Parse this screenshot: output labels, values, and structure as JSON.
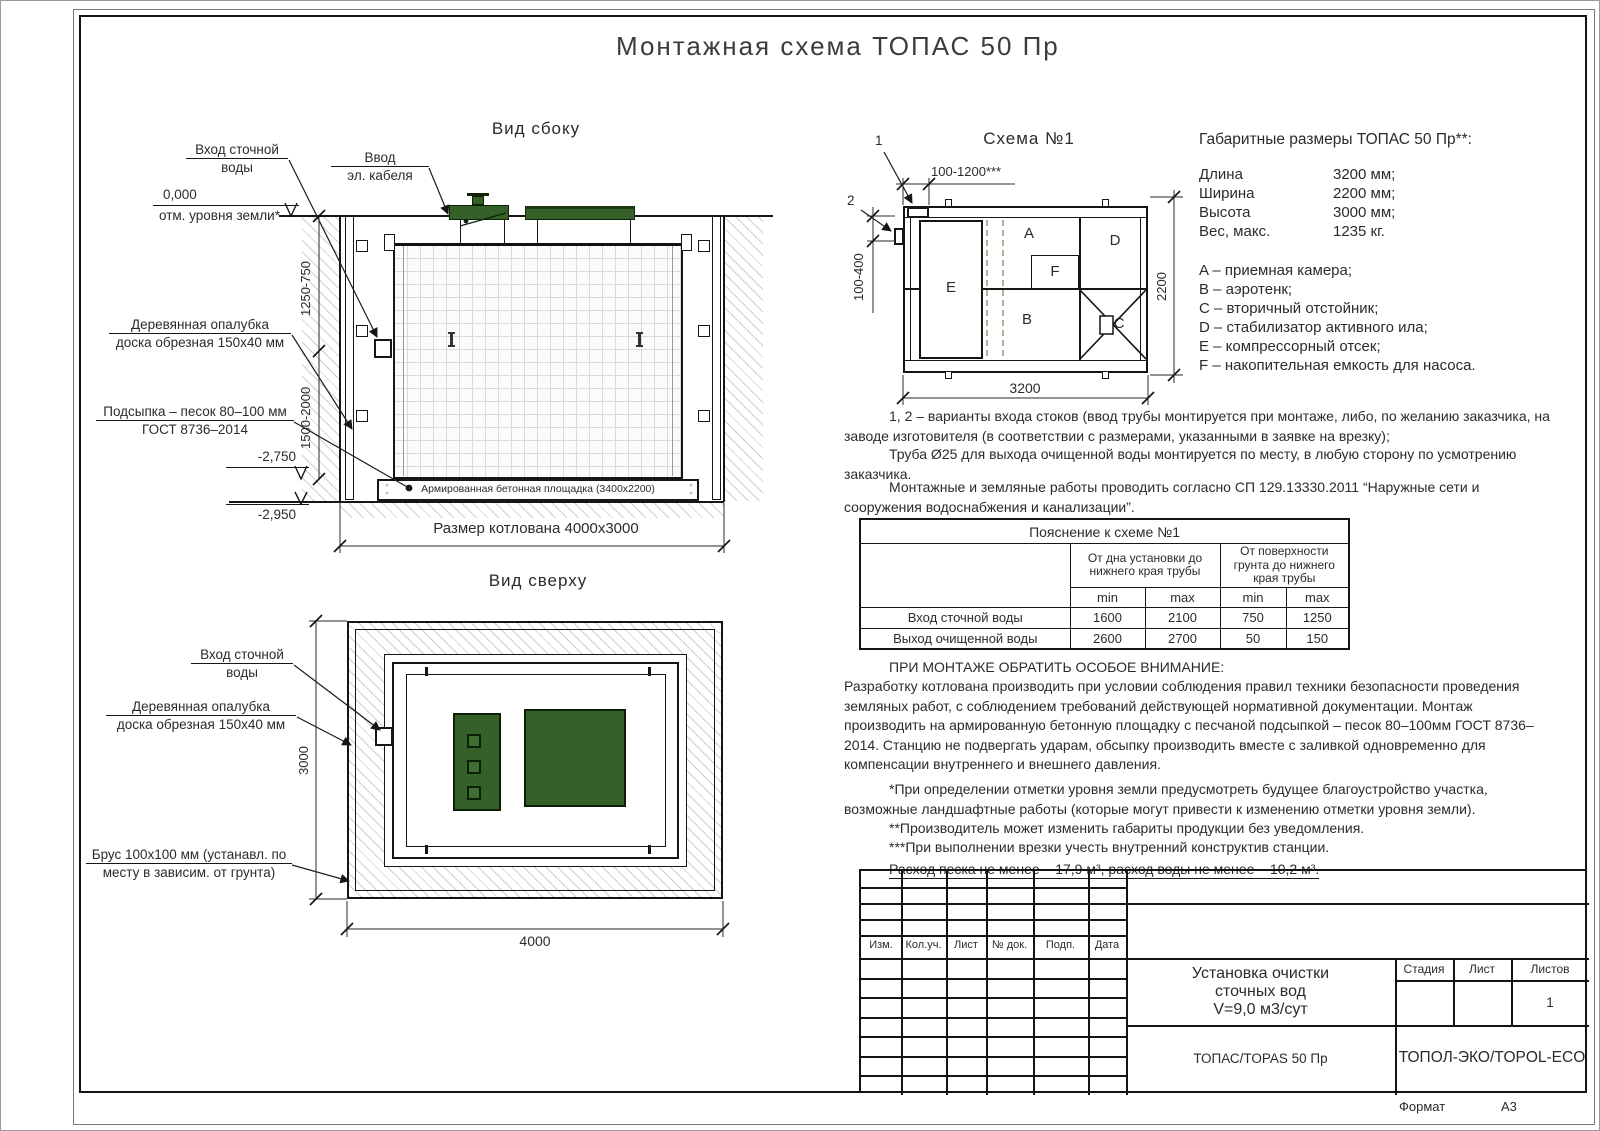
{
  "page": {
    "title": "Монтажная схема ТОПАС 50 Пр",
    "format_label": "Формат",
    "format_value": "А3"
  },
  "side_view": {
    "title": "Вид сбоку",
    "inlet_label_1": "Вход сточной",
    "inlet_label_2": "воды",
    "cable_label_1": "Ввод",
    "cable_label_2": "эл. кабеля",
    "level_zero": "0,000",
    "level_zero_sub": "отм. уровня земли*",
    "dim_upper": "1250-750",
    "dim_lower": "1500-2000",
    "formwork_label_1": "Деревянная опалубка",
    "formwork_label_2": "доска обрезная 150x40 мм",
    "bedding_label_1": "Подсыпка – песок 80–100 мм",
    "bedding_label_2": "ГОСТ 8736–2014",
    "level_slab": "-2,750",
    "level_bottom": "-2,950",
    "slab_label": "Армированная бетонная площадка (3400x2200)",
    "pit_label": "Размер котлована 4000x3000"
  },
  "top_view": {
    "title": "Вид сверху",
    "inlet_label_1": "Вход сточной",
    "inlet_label_2": "воды",
    "formwork_label_1": "Деревянная опалубка",
    "formwork_label_2": "доска обрезная 150x40 мм",
    "beam_label_1": "Брус 100x100 мм (устанавл. по",
    "beam_label_2": "месту в зависим. от грунта)",
    "dim_height": "3000",
    "dim_width": "4000"
  },
  "schema": {
    "title": "Схема №1",
    "callout_1": "1",
    "callout_2": "2",
    "dim_top": "100-1200***",
    "dim_left": "100-400",
    "dim_right": "2200",
    "dim_bottom": "3200",
    "compartments": {
      "a": "A",
      "b": "B",
      "c": "C",
      "d": "D",
      "e": "E",
      "f": "F"
    }
  },
  "specs": {
    "title": "Габаритные размеры ТОПАС 50 Пр**:",
    "rows": [
      {
        "label": "Длина",
        "value": "3200 мм;"
      },
      {
        "label": "Ширина",
        "value": "2200 мм;"
      },
      {
        "label": "Высота",
        "value": "3000 мм;"
      },
      {
        "label": "Вес, макс.",
        "value": "1235 кг."
      }
    ],
    "legend": [
      "A – приемная камера;",
      "B – аэротенк;",
      "C – вторичный отстойник;",
      "D – стабилизатор активного ила;",
      "E – компрессорный отсек;",
      "F – накопительная емкость для насоса."
    ]
  },
  "notes": {
    "p1": "1, 2 – варианты входа  стоков (ввод трубы монтируется при монтаже, либо, по желанию заказчика, на заводе изготовителя (в соответствии с размерами, указанными в заявке на врезку);",
    "p2": "Труба Ø25 для выхода очищенной воды монтируется по месту, в любую сторону по усмотрению заказчика.",
    "p3": "Монтажные и земляные работы проводить согласно СП 129.13330.2011 “Наружные сети и сооружения водоснабжения и канализации”."
  },
  "explain_table": {
    "title": "Пояснение к схеме №1",
    "group1": "От дна установки до нижнего края трубы",
    "group2": "От поверхности грунта до нижнего края трубы",
    "min_label": "min",
    "max_label": "max",
    "rows": [
      {
        "label": "Вход сточной воды",
        "v1": "1600",
        "v2": "2100",
        "v3": "750",
        "v4": "1250"
      },
      {
        "label": "Выход очищенной воды",
        "v1": "2600",
        "v2": "2700",
        "v3": "50",
        "v4": "150"
      }
    ]
  },
  "attention": {
    "heading": "ПРИ МОНТАЖЕ ОБРАТИТЬ ОСОБОЕ ВНИМАНИЕ:",
    "body": "Разработку котлована производить при условии соблюдения правил техники безопасности проведения земляных работ, с соблюдением требований действующей нормативной документации.  Монтаж производить на армированную бетонную площадку с песчаной подсыпкой – песок 80–100мм ГОСТ 8736–2014. Станцию не подвергать ударам, обсыпку производить вместе с заливкой одновременно для компенсации внутреннего и внешнего давления.",
    "fn1": "*При определении отметки уровня земли предусмотреть будущее благоустройство участка, возможные ландшафтные работы (которые могут привести к изменению отметки уровня земли).",
    "fn2": "**Производитель может изменить габариты продукции без уведомления.",
    "fn3": "***При выполнении врезки учесть внутренний конструктив станции.",
    "consumption": "Расход песка не менее – 17,9 м³, расход воды не менее – 10,2 м³."
  },
  "title_block": {
    "cols": [
      "Изм.",
      "Кол.уч.",
      "Лист",
      "№ док.",
      "Подп.",
      "Дата"
    ],
    "doc_title_1": "Установка очистки",
    "doc_title_2": "сточных вод",
    "doc_title_3": "V=9,0 м3/сут",
    "product": "ТОПАС/TOPAS 50 Пр",
    "company": "ТОПОЛ-ЭКО/TOPOL-ECO",
    "stage": "Стадия",
    "sheet": "Лист",
    "sheets": "Листов",
    "sheets_value": "1"
  }
}
